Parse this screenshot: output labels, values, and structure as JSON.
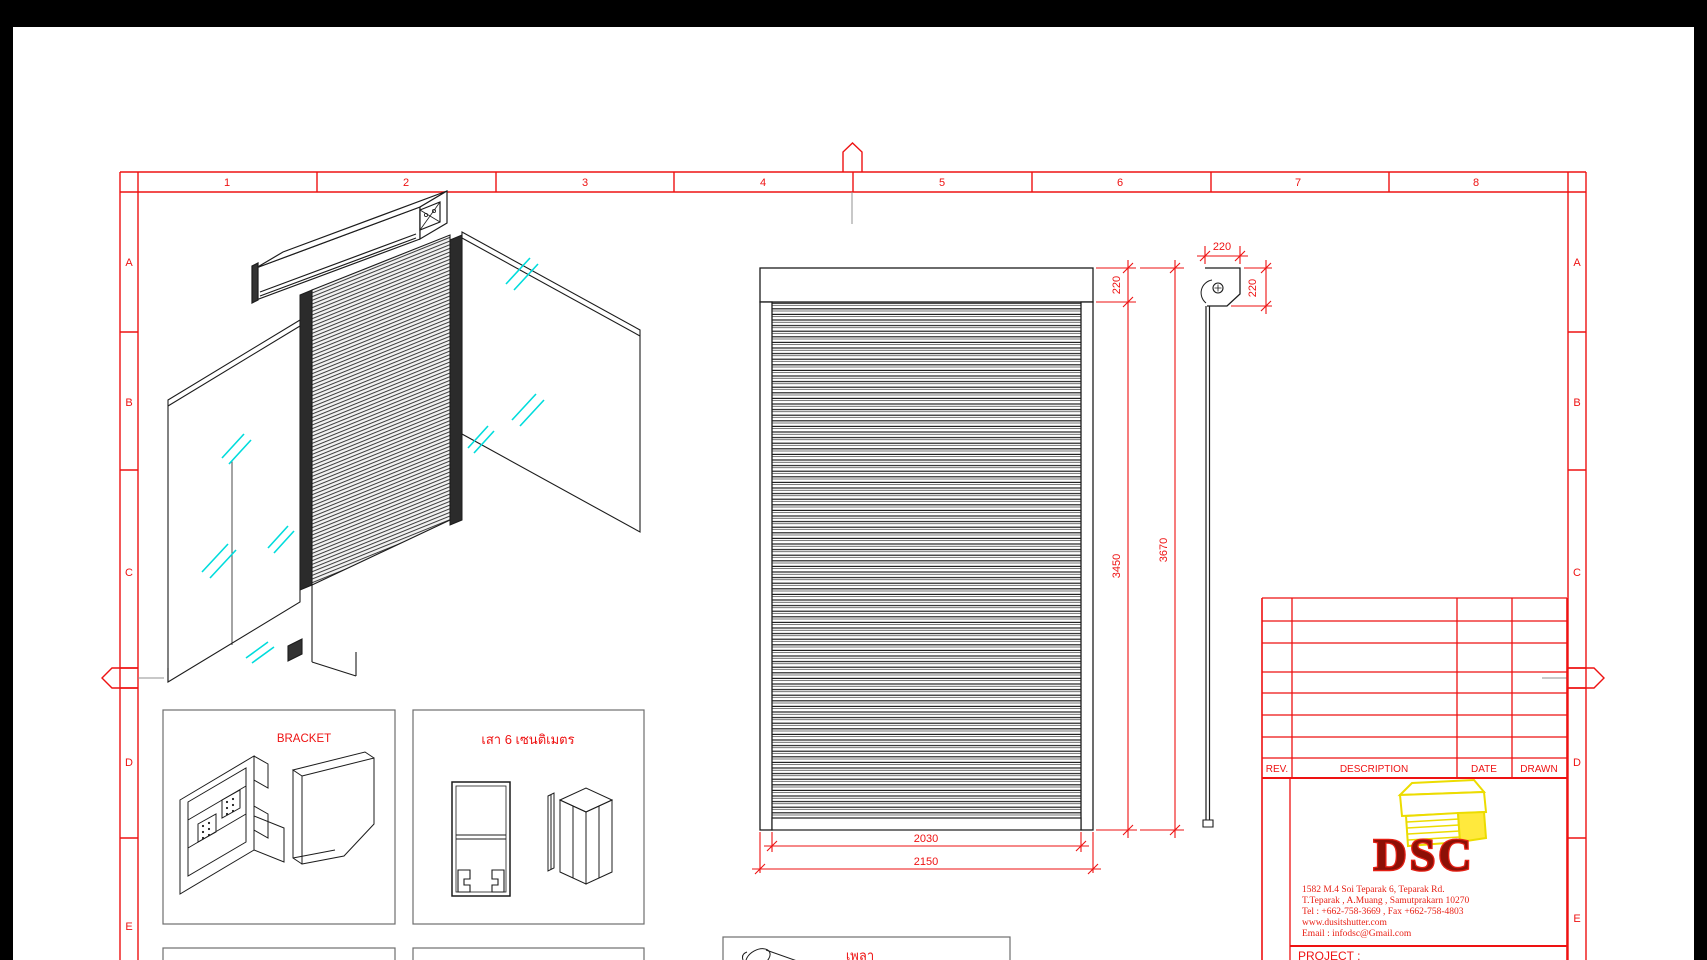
{
  "frame": {
    "columns": [
      "1",
      "2",
      "3",
      "4",
      "5",
      "6",
      "7",
      "8"
    ],
    "rows": [
      "A",
      "B",
      "C",
      "D",
      "E"
    ]
  },
  "dims": {
    "hood_h": "220",
    "curtain_h": "3450",
    "total_h": "3670",
    "opening_w": "2030",
    "overall_w": "2150",
    "section_w": "220",
    "section_h": "220"
  },
  "panels": {
    "bracket": "BRACKET",
    "post": "เสา 6 เซนติเมตร",
    "shaft": "เพลา"
  },
  "titleblock": {
    "rev": "REV.",
    "description": "DESCRIPTION",
    "date": "DATE",
    "drawn": "DRAWN",
    "logo": "DSC",
    "address": [
      "1582 M.4 Soi Teparak 6, Teparak Rd.",
      "T.Teparak , A.Muang , Samutprakarn 10270",
      "Tel : +662-758-3669 , Fax +662-758-4803",
      "www.dusitshutter.com",
      "Email : infodsc@Gmail.com"
    ],
    "project": "PROJECT :"
  },
  "colors": {
    "frame_red": "#ee1212",
    "line_black": "#1c1c1c",
    "glass_cyan": "#00dcdc",
    "logo_yellow": "#ecdc00",
    "logo_dark_red": "#8c1006",
    "marker_gray": "#909090",
    "bar_black": "#000000"
  }
}
